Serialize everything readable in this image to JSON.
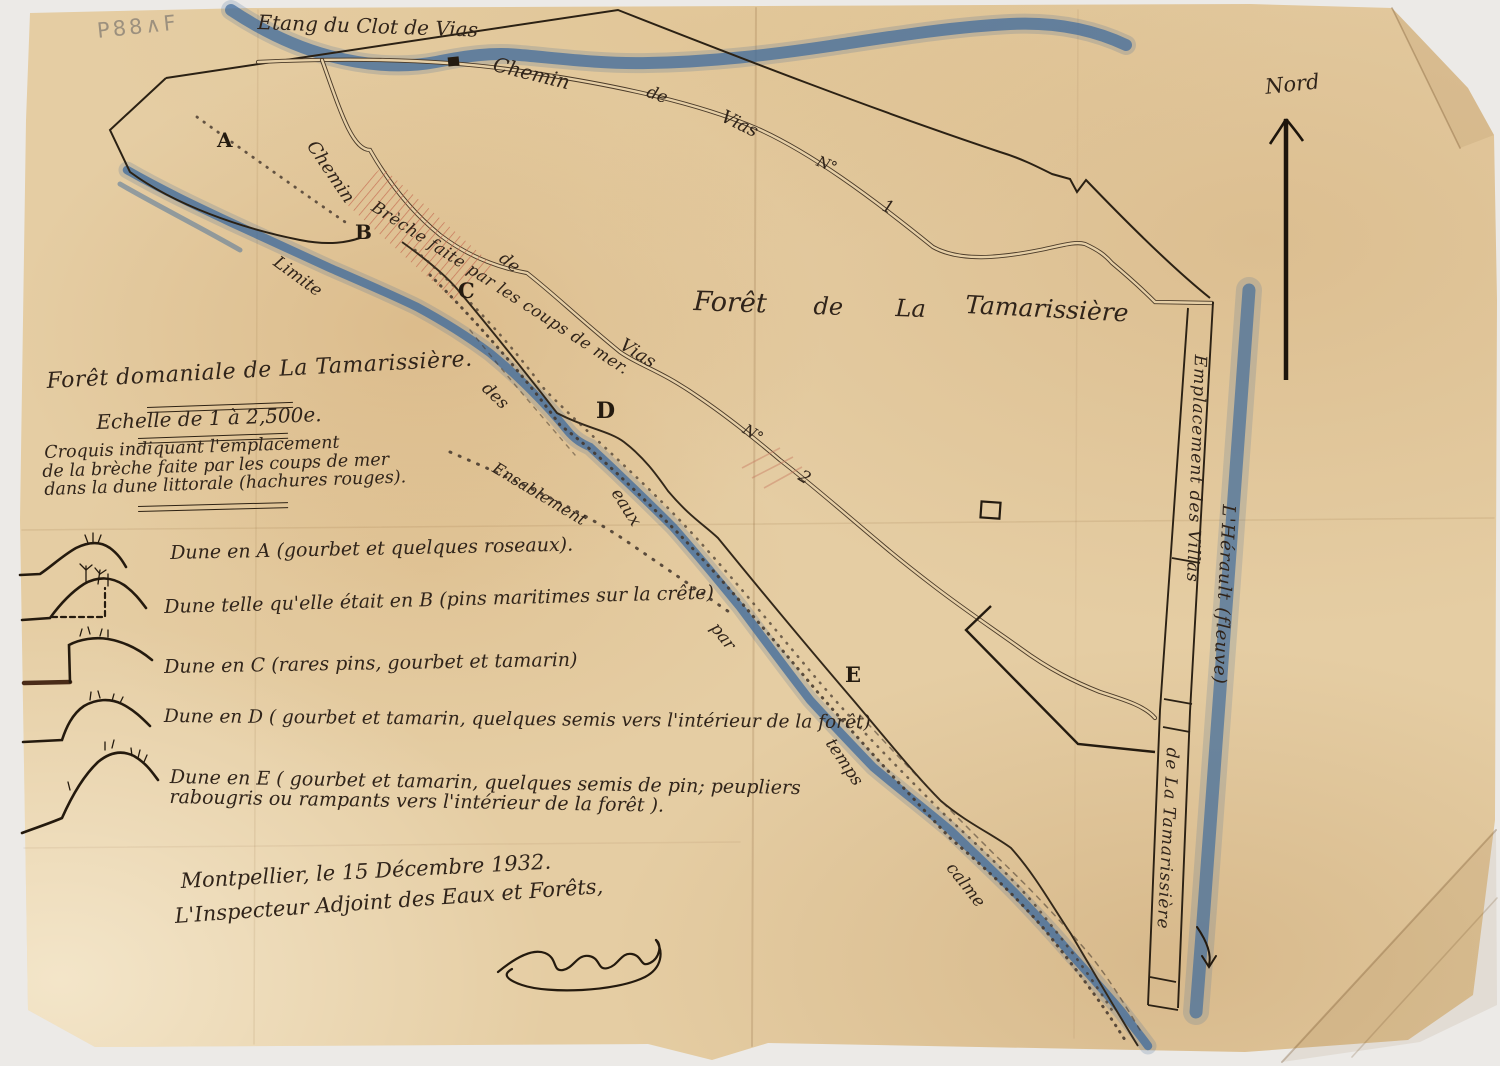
{
  "colors": {
    "paper": "#e5cda3",
    "ink": "#2e2214",
    "blue": "#3f6b9c",
    "red": "#c2604a",
    "pencil": "#8a8276"
  },
  "archival_code": "P88∧F",
  "compass": {
    "north_label": "Nord"
  },
  "waters": {
    "etang": "Etang du Clot de Vias",
    "river": "L'Hérault  (fleuve)",
    "waterline": {
      "words": [
        "Limite",
        "des",
        "eaux",
        "par",
        "temps",
        "calme"
      ]
    }
  },
  "roads": {
    "chemin_vias_1": {
      "words": [
        "Chemin",
        "de",
        "Vias",
        "N°",
        "1"
      ]
    },
    "chemin_vias_2": {
      "words": [
        "Chemin",
        "de",
        "Vias",
        "N°",
        "2"
      ]
    }
  },
  "map_labels": {
    "forest_title_words": [
      "Forêt",
      "de",
      "La",
      "Tamarissière"
    ],
    "breach": "Brèche faite par les coups de mer.",
    "accretion": "Ensablement",
    "points": [
      "A",
      "B",
      "C",
      "D",
      "E"
    ],
    "villas_strip_upper": "Emplacement des Villas",
    "villas_strip_lower": "de La Tamarissière"
  },
  "note_block": {
    "title": "Forêt domaniale de La Tamarissière.",
    "scale": "Echelle de 1 à 2,500e.",
    "description_lines": [
      "Croquis indiquant l'emplacement",
      "de la brèche faite par les coups de mer",
      "dans la dune littorale (hachures rouges)."
    ]
  },
  "legend_entries": [
    "Dune en A  (gourbet et quelques roseaux).",
    "Dune telle qu'elle était en B  (pins maritimes sur la crête)",
    "Dune en C   (rares pins, gourbet et tamarin)",
    "Dune en D  ( gourbet et tamarin, quelques semis vers l'intérieur de la forêt)",
    "Dune en E  ( gourbet et tamarin, quelques semis de pin; peupliers rabougris ou rampants vers l'intérieur de la forêt )."
  ],
  "signature_block": {
    "place_date": "Montpellier, le 15 Décembre 1932.",
    "signatory_title": "L'Inspecteur Adjoint des Eaux et Forêts,"
  }
}
